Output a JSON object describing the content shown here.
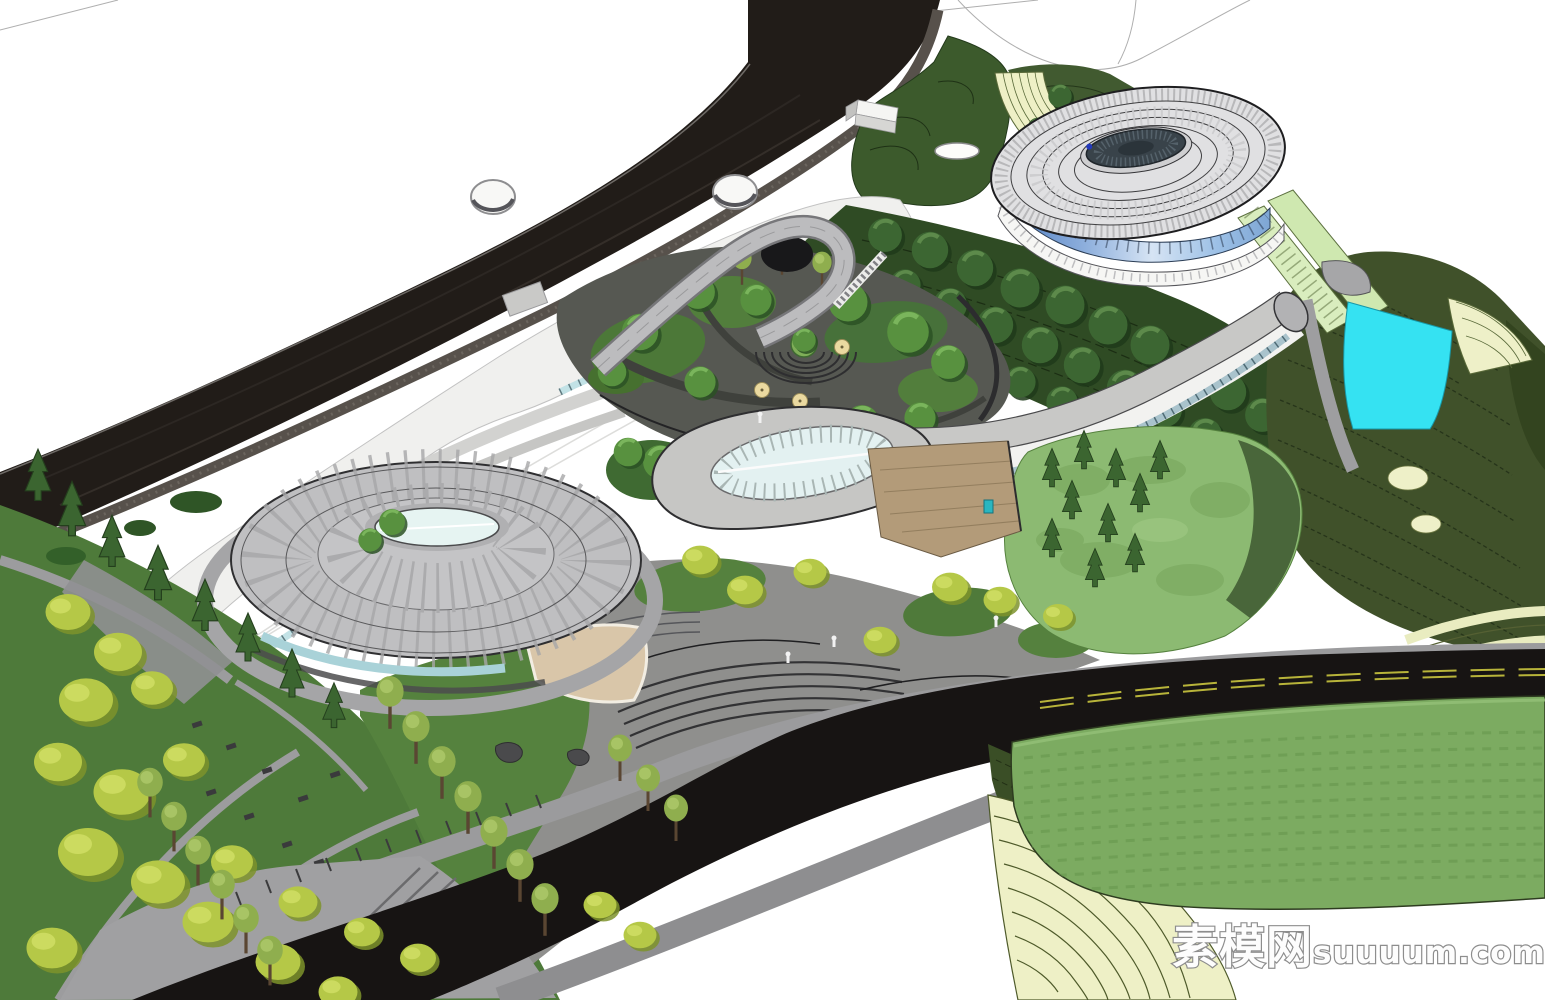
{
  "watermark": {
    "text": "素模网suuuum.com",
    "cjk": "素模网",
    "latin": "suuuum.com"
  },
  "colors": {
    "background": "#ffffff",
    "road_asphalt": "#171413",
    "perimeter_wall_dark": "#211c18",
    "sidewalk_gray": "#9b9b9d",
    "roof_plaza_white": "#f0f0ee",
    "roof_gray": "#b9b9bb",
    "dome_roof_gray": "#e0e0e2",
    "dome_glass_blue": "#8fb0dd",
    "skylight_glass": "#e3f1f1",
    "water_cyan": "#35e2f2",
    "hill_dark_green": "#40512a",
    "forest_green": "#2f4b24",
    "lawn_green": "#4e7a3a",
    "mound_green": "#8cba72",
    "field_green": "#7cab61",
    "terrace_cream": "#eef0c6",
    "ramp_pale_green": "#d9edbe",
    "tree_yellow": "#b5c847",
    "tree_dark_green": "#3c6632",
    "lane_marking_yellow": "#b8b43a",
    "deck_wood": "#b39b79",
    "watermark_fill": "#fdfdfd",
    "watermark_outline": "#8d8d8d"
  },
  "scene": {
    "type": "3d-architectural-site-render",
    "style": "aerial axonometric SketchUp-style model",
    "elements": [
      "perimeter-road-retaining-wall",
      "white-flat-roof-plaza",
      "sunken-courtyard-garden",
      "circular-amphitheater",
      "round-roof-pavilion-with-skylight",
      "teardrop-skylight-canopy",
      "curved-roof-wing",
      "gridshell-dome-hall",
      "dome-glass-curtain-wall",
      "hillside-terraces",
      "cyan-water-feature",
      "terraced-cream-fields",
      "crop-field-with-rows",
      "main-asphalt-road",
      "landscaped-slope-with-trees",
      "stepped-plaza"
    ]
  }
}
